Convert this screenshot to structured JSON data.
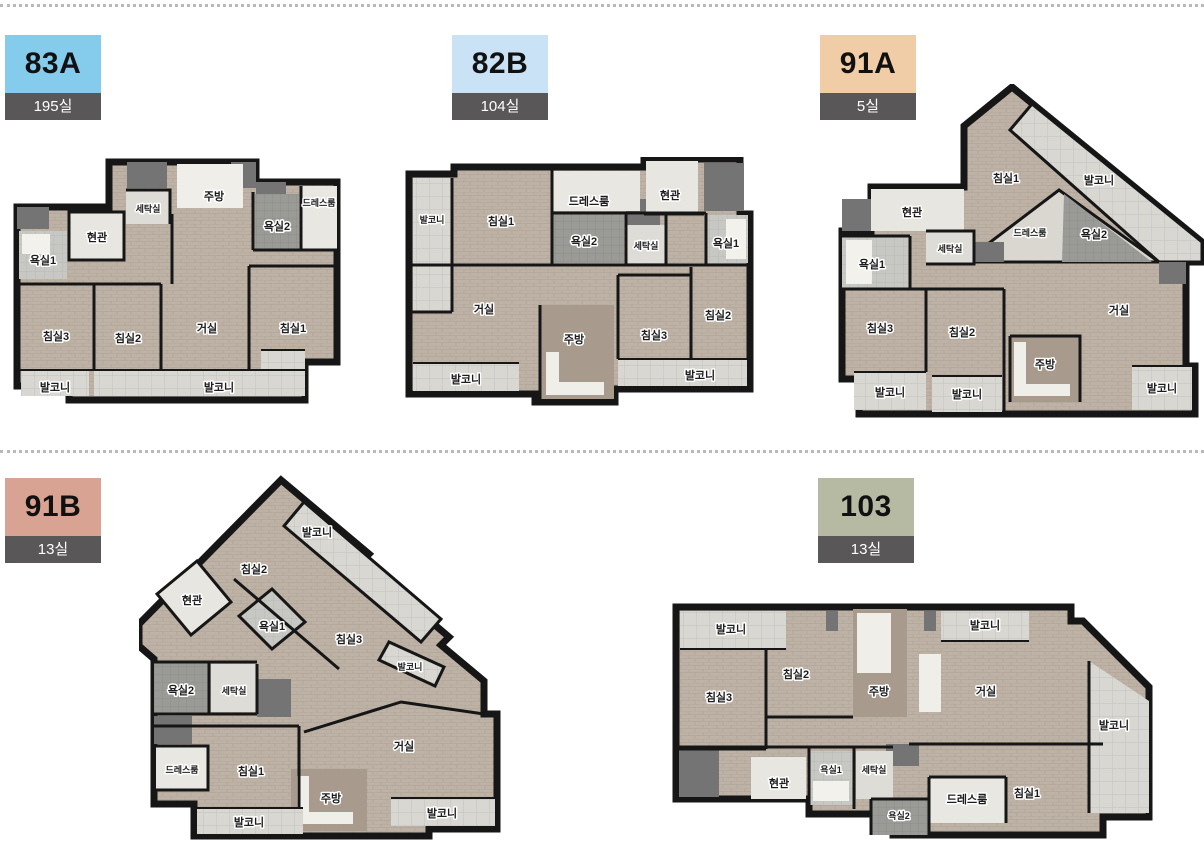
{
  "theme": {
    "badge_count_bg": "#595757",
    "badge_text": "#111111",
    "wall_color": "#161616",
    "floor_color": "#bdb2a5",
    "balcony_tile": "#d8d7d2"
  },
  "plans": [
    {
      "name": "83A",
      "count": "195실",
      "accent": "#85cbec",
      "rooms": [
        "주방",
        "세탁실",
        "드레스룸",
        "현관",
        "욕실2",
        "욕실1",
        "침실3",
        "침실2",
        "거실",
        "침실1",
        "발코니",
        "발코니"
      ]
    },
    {
      "name": "82B",
      "count": "104실",
      "accent": "#c9e2f5",
      "rooms": [
        "발코니",
        "침실1",
        "드레스룸",
        "현관",
        "욕실2",
        "세탁실",
        "욕실1",
        "거실",
        "주방",
        "침실3",
        "침실2",
        "발코니",
        "발코니"
      ]
    },
    {
      "name": "91A",
      "count": "5실",
      "accent": "#f0cda7",
      "rooms": [
        "침실1",
        "발코니",
        "드레스룸",
        "욕실2",
        "현관",
        "세탁실",
        "욕실1",
        "침실3",
        "침실2",
        "거실",
        "주방",
        "발코니",
        "발코니",
        "발코니"
      ]
    },
    {
      "name": "91B",
      "count": "13실",
      "accent": "#d8a392",
      "rooms": [
        "발코니",
        "침실2",
        "현관",
        "욕실1",
        "침실3",
        "발코니",
        "욕실2",
        "세탁실",
        "드레스룸",
        "침실1",
        "거실",
        "주방",
        "발코니",
        "발코니"
      ]
    },
    {
      "name": "103",
      "count": "13실",
      "accent": "#b6baa2",
      "rooms": [
        "발코니",
        "침실2",
        "침실3",
        "주방",
        "거실",
        "발코니",
        "발코니",
        "현관",
        "욕실1",
        "세탁실",
        "욕실2",
        "드레스룸",
        "침실1"
      ]
    }
  ]
}
